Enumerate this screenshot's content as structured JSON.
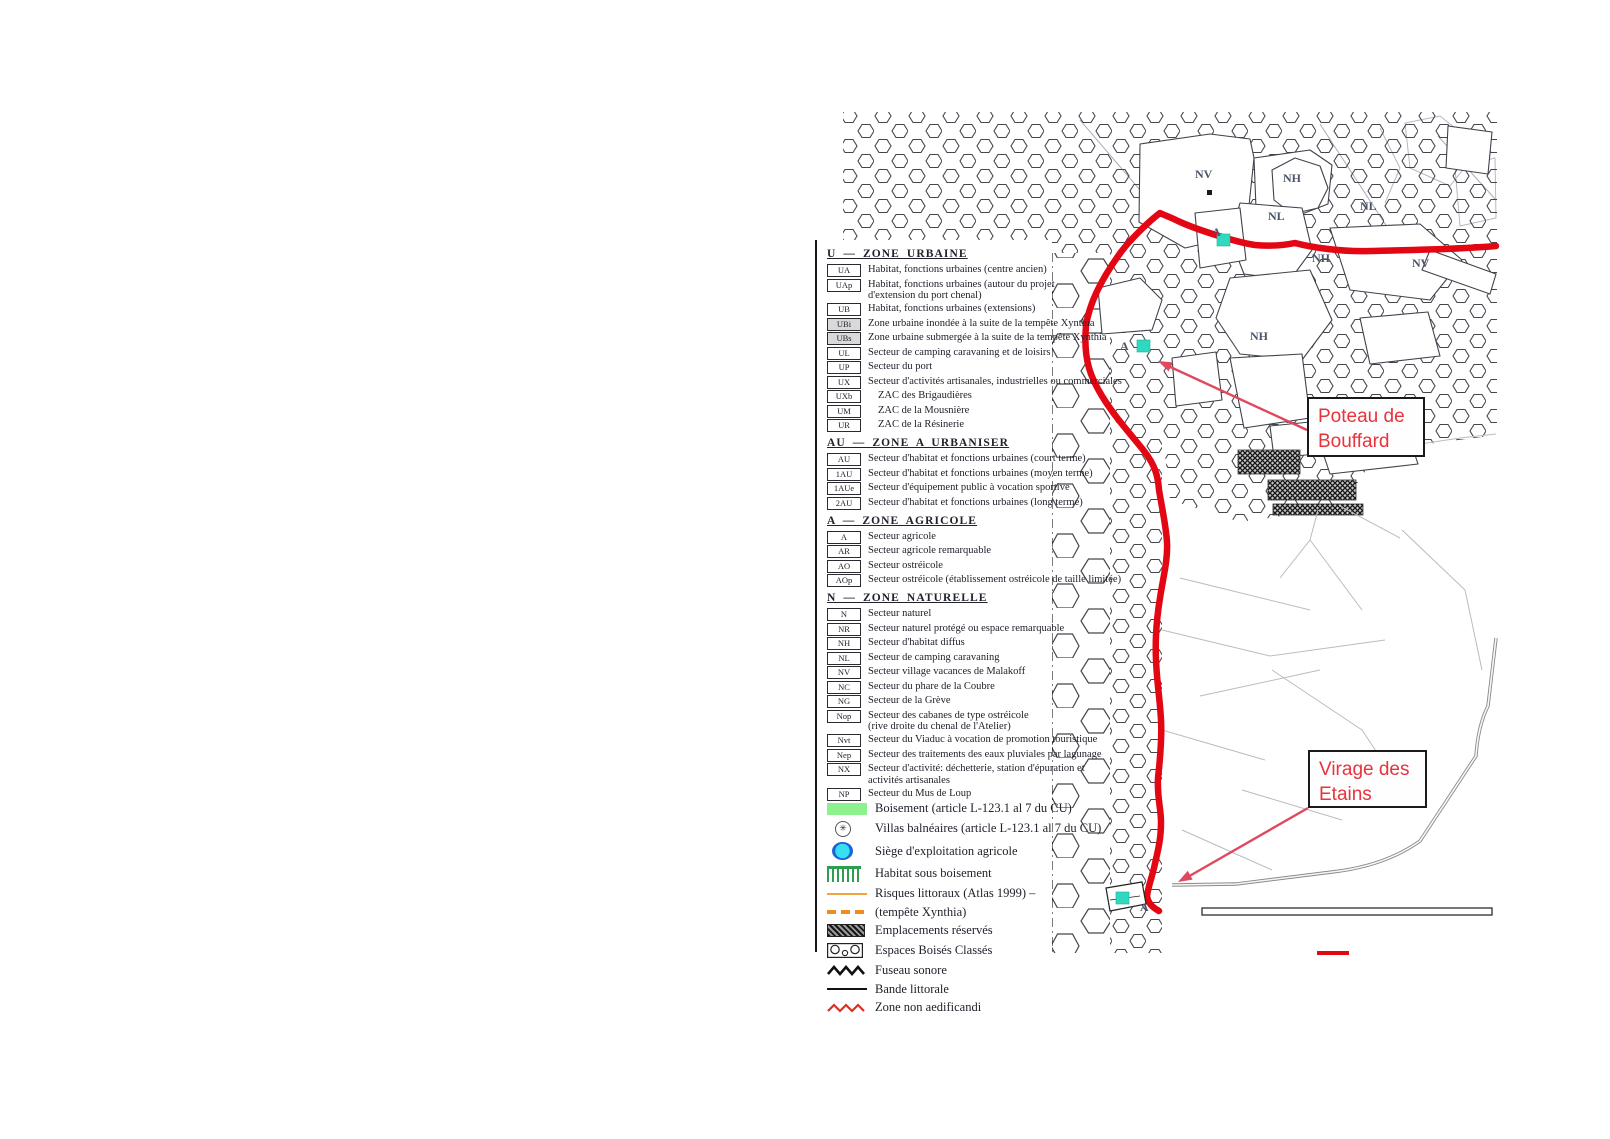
{
  "colors": {
    "route-red": "#e30613",
    "arrow-pink": "#e0485e",
    "annotation-red": "#e8323c",
    "boisement-green": "#8df28d",
    "habitat-green": "#2e9e4f",
    "siege-cyan": "#35e0f2",
    "siege-blue": "#1d62d8",
    "risques-orange": "#f5a33c",
    "xynthia-orange": "#ef8c1e",
    "teal-marker": "#2fd9c0",
    "zigzag-red": "#d93025"
  },
  "legend": {
    "sections": [
      {
        "header": "U — ZONE URBAINE",
        "items": [
          {
            "code": "UA",
            "label": "Habitat, fonctions urbaines (centre ancien)"
          },
          {
            "code": "UAp",
            "label": "Habitat, fonctions urbaines (autour du projet\nd'extension du port chenal)"
          },
          {
            "code": "UB",
            "label": "Habitat, fonctions urbaines (extensions)"
          },
          {
            "code": "UBi",
            "label": "Zone urbaine inondée à la suite de la tempête Xynthia",
            "shaded": true
          },
          {
            "code": "UBs",
            "label": "Zone urbaine submergée à la suite de la tempête Xynthia",
            "shaded": true
          },
          {
            "code": "UL",
            "label": "Secteur de camping caravaning et de loisirs"
          },
          {
            "code": "UP",
            "label": "Secteur du port"
          },
          {
            "code": "UX",
            "label": "Secteur d'activités artisanales, industrielles ou commerciales"
          },
          {
            "code": "UXb",
            "label": "ZAC des Brigaudières",
            "zac": true
          },
          {
            "code": "UM",
            "label": "ZAC de la Mousnière",
            "zac": true
          },
          {
            "code": "UR",
            "label": "ZAC de la Résinerie",
            "zac": true
          }
        ]
      },
      {
        "header": "AU — ZONE A URBANISER",
        "items": [
          {
            "code": "AU",
            "label": "Secteur d'habitat et fonctions urbaines (court terme)"
          },
          {
            "code": "1AU",
            "label": "Secteur d'habitat et fonctions urbaines (moyen terme)"
          },
          {
            "code": "1AUe",
            "label": "Secteur d'équipement public à vocation sportive"
          },
          {
            "code": "2AU",
            "label": "Secteur d'habitat et fonctions urbaines (long terme)"
          }
        ]
      },
      {
        "header": "A — ZONE AGRICOLE",
        "items": [
          {
            "code": "A",
            "label": "Secteur agricole"
          },
          {
            "code": "AR",
            "label": "Secteur agricole remarquable"
          },
          {
            "code": "AO",
            "label": "Secteur ostréicole"
          },
          {
            "code": "AOp",
            "label": "Secteur ostréicole (établissement ostréicole de taille limitée)"
          }
        ]
      },
      {
        "header": "N — ZONE NATURELLE",
        "items": [
          {
            "code": "N",
            "label": "Secteur naturel"
          },
          {
            "code": "NR",
            "label": "Secteur naturel protégé ou espace remarquable"
          },
          {
            "code": "NH",
            "label": "Secteur d'habitat diffus"
          },
          {
            "code": "NL",
            "label": "Secteur de camping caravaning"
          },
          {
            "code": "NV",
            "label": "Secteur village vacances de Malakoff"
          },
          {
            "code": "NC",
            "label": "Secteur du phare de la Coubre"
          },
          {
            "code": "NG",
            "label": "Secteur de la Grève"
          },
          {
            "code": "Nop",
            "label": "Secteur des cabanes de type ostréicole\n(rive droite du chenal de l'Atelier)"
          },
          {
            "code": "Nvt",
            "label": "Secteur du Viaduc à vocation de promotion touristique"
          },
          {
            "code": "Nep",
            "label": "Secteur des traitements des eaux pluviales par lagunage"
          },
          {
            "code": "NX",
            "label": "Secteur d'activité: déchetterie, station d'épuration et\nactivités artisanales"
          },
          {
            "code": "NP",
            "label": "Secteur du Mus de Loup"
          }
        ]
      }
    ],
    "symbols": [
      {
        "symbol": "boisement",
        "icon": "boisement-swatch-icon",
        "label": "Boisement (article L-123.1 al 7 du CU)"
      },
      {
        "symbol": "villas",
        "icon": "villas-balneaires-icon",
        "label": "Villas balnéaires (article L-123.1 al 7 du CU)",
        "glyph": "✳"
      },
      {
        "symbol": "siege",
        "icon": "siege-exploitation-agricole-icon",
        "label": "Siège d'exploitation agricole"
      },
      {
        "symbol": "habitat",
        "icon": "habitat-sous-boisement-icon",
        "label": "Habitat sous boisement"
      },
      {
        "symbol": "risques",
        "icon": "risques-littoraux-line-icon",
        "label": "Risques littoraux (Atlas 1999) –"
      },
      {
        "symbol": "xynthia",
        "icon": "tempete-xynthia-dashed-line-icon",
        "label": "(tempête Xynthia)"
      },
      {
        "symbol": "emplacements",
        "icon": "emplacements-reserves-swatch-icon",
        "label": "Emplacements réservés"
      },
      {
        "symbol": "ebc",
        "icon": "espaces-boises-classes-swatch-icon",
        "label": "Espaces Boisés Classés"
      },
      {
        "symbol": "fuseau",
        "icon": "fuseau-sonore-zigzag-icon",
        "label": "Fuseau sonore"
      },
      {
        "symbol": "bande",
        "icon": "bande-littorale-line-icon",
        "label": "Bande littorale"
      },
      {
        "symbol": "znae",
        "icon": "zone-non-aedificandi-zigzag-icon",
        "label": "Zone non aedificandi"
      }
    ]
  },
  "map": {
    "annotations": {
      "poteau": {
        "text": "Poteau de\nBouffard"
      },
      "virage": {
        "text": "Virage des\nEtains"
      }
    },
    "zone_labels": [
      {
        "text": "NV",
        "x": 355,
        "y": 70
      },
      {
        "text": "NH",
        "x": 443,
        "y": 74
      },
      {
        "text": "NL",
        "x": 428,
        "y": 112
      },
      {
        "text": "NL",
        "x": 520,
        "y": 102
      },
      {
        "text": "NH",
        "x": 472,
        "y": 154
      },
      {
        "text": "NV",
        "x": 572,
        "y": 159
      },
      {
        "text": "A",
        "x": 372,
        "y": 128
      },
      {
        "text": "NH",
        "x": 410,
        "y": 232
      },
      {
        "text": "A",
        "x": 280,
        "y": 242
      },
      {
        "text": "A",
        "x": 300,
        "y": 803
      }
    ],
    "markers": [
      {
        "kind": "siege",
        "x": 377,
        "y": 126
      },
      {
        "kind": "siege",
        "x": 297,
        "y": 232
      },
      {
        "kind": "siege",
        "x": 276,
        "y": 784
      },
      {
        "kind": "dot",
        "x": 367,
        "y": 82
      }
    ]
  }
}
